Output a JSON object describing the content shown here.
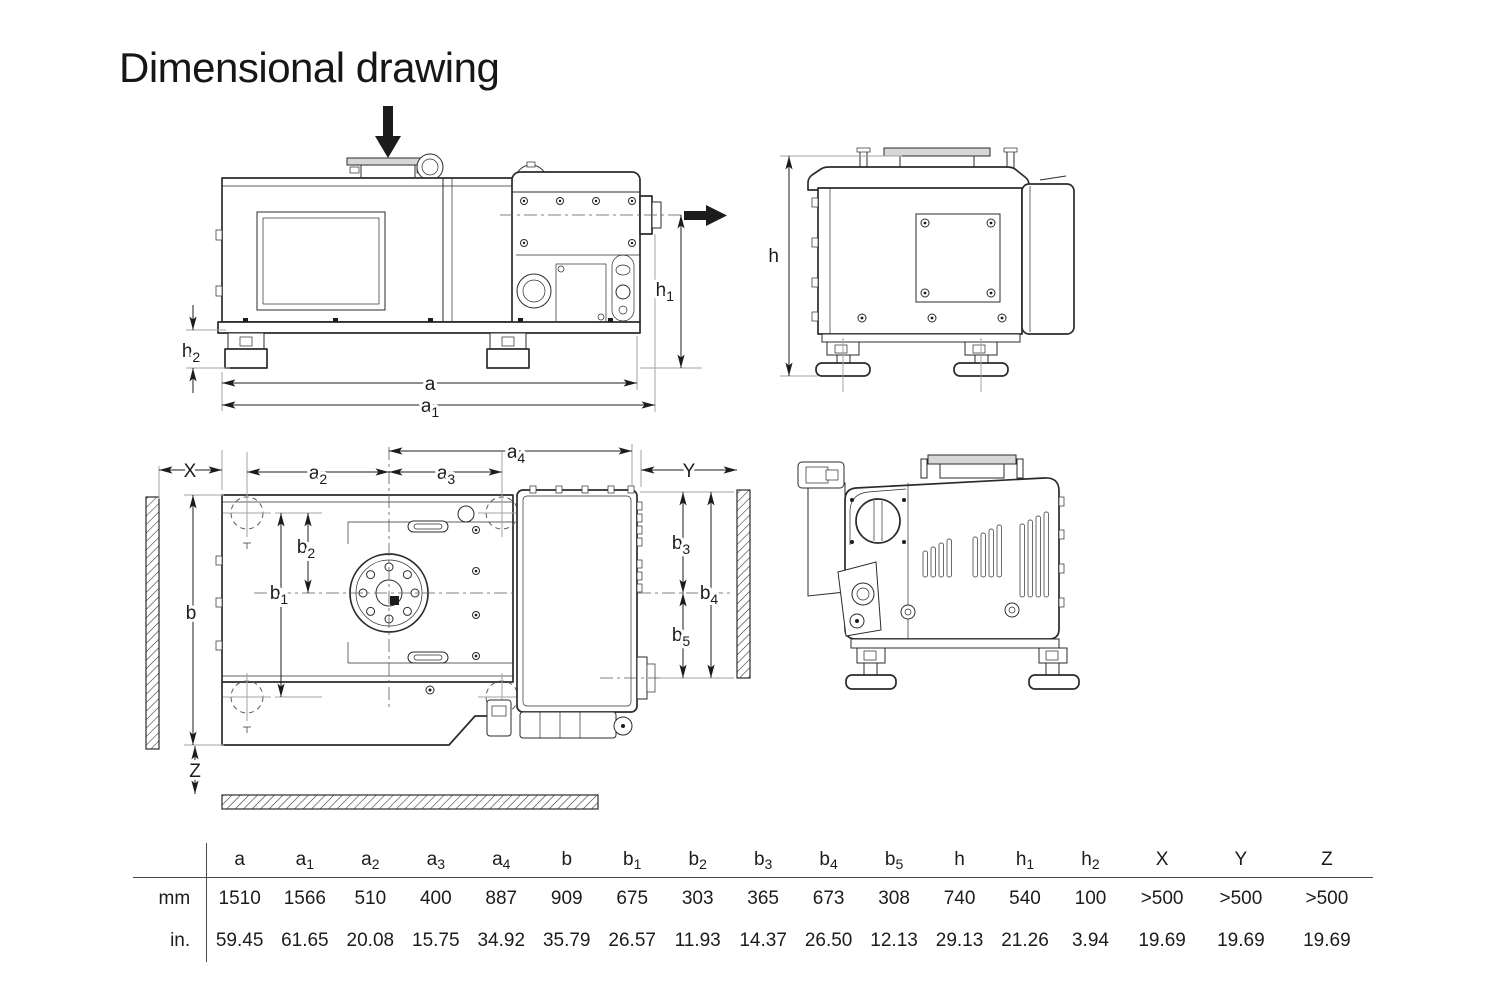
{
  "title": "Dimensional drawing",
  "colors": {
    "ink": "#1c1c1c",
    "line": "#2b2b2b",
    "extension": "#a3a3a3",
    "flange_fill": "#d7d7d7"
  },
  "dims": {
    "a": {
      "base": "a",
      "sub": ""
    },
    "a1": {
      "base": "a",
      "sub": "1"
    },
    "a2": {
      "base": "a",
      "sub": "2"
    },
    "a3": {
      "base": "a",
      "sub": "3"
    },
    "a4": {
      "base": "a",
      "sub": "4"
    },
    "b": {
      "base": "b",
      "sub": ""
    },
    "b1": {
      "base": "b",
      "sub": "1"
    },
    "b2": {
      "base": "b",
      "sub": "2"
    },
    "b3": {
      "base": "b",
      "sub": "3"
    },
    "b4": {
      "base": "b",
      "sub": "4"
    },
    "b5": {
      "base": "b",
      "sub": "5"
    },
    "h": {
      "base": "h",
      "sub": ""
    },
    "h1": {
      "base": "h",
      "sub": "1"
    },
    "h2": {
      "base": "h",
      "sub": "2"
    },
    "X": {
      "base": "X",
      "sub": ""
    },
    "Y": {
      "base": "Y",
      "sub": ""
    },
    "Z": {
      "base": "Z",
      "sub": ""
    }
  },
  "table": {
    "row_labels": [
      "mm",
      "in."
    ],
    "columns": [
      {
        "base": "a",
        "sub": "",
        "mm": "1510",
        "in": "59.45"
      },
      {
        "base": "a",
        "sub": "1",
        "mm": "1566",
        "in": "61.65"
      },
      {
        "base": "a",
        "sub": "2",
        "mm": "510",
        "in": "20.08"
      },
      {
        "base": "a",
        "sub": "3",
        "mm": "400",
        "in": "15.75"
      },
      {
        "base": "a",
        "sub": "4",
        "mm": "887",
        "in": "34.92"
      },
      {
        "base": "b",
        "sub": "",
        "mm": "909",
        "in": "35.79"
      },
      {
        "base": "b",
        "sub": "1",
        "mm": "675",
        "in": "26.57"
      },
      {
        "base": "b",
        "sub": "2",
        "mm": "303",
        "in": "11.93"
      },
      {
        "base": "b",
        "sub": "3",
        "mm": "365",
        "in": "14.37"
      },
      {
        "base": "b",
        "sub": "4",
        "mm": "673",
        "in": "26.50"
      },
      {
        "base": "b",
        "sub": "5",
        "mm": "308",
        "in": "12.13"
      },
      {
        "base": "h",
        "sub": "",
        "mm": "740",
        "in": "29.13"
      },
      {
        "base": "h",
        "sub": "1",
        "mm": "540",
        "in": "21.26"
      },
      {
        "base": "h",
        "sub": "2",
        "mm": "100",
        "in": "3.94"
      },
      {
        "base": "X",
        "sub": "",
        "mm": ">500",
        "in": "19.69"
      },
      {
        "base": "Y",
        "sub": "",
        "mm": ">500",
        "in": "19.69"
      },
      {
        "base": "Z",
        "sub": "",
        "mm": ">500",
        "in": "19.69"
      }
    ]
  }
}
